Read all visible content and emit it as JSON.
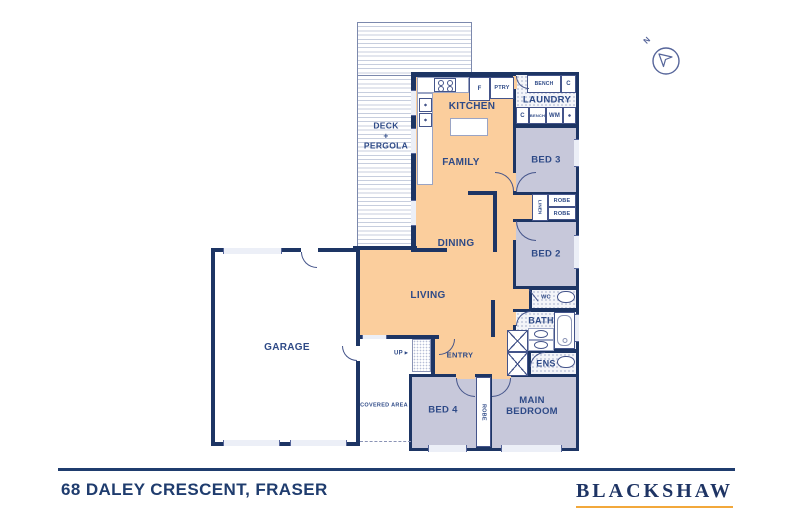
{
  "colors": {
    "wall_navy": "#1d3564",
    "label_blue": "#2e4a87",
    "living_orange": "#fbce9d",
    "bedroom_purple": "#c7c8da",
    "brand_navy": "#1e3464",
    "brand_gold": "#f2a83b"
  },
  "plan": {
    "rooms": {
      "deck": {
        "line1": "DECK",
        "line2": "+",
        "line3": "PERGOLA"
      },
      "kitchen": {
        "label": "KITCHEN"
      },
      "family": {
        "label": "FAMILY"
      },
      "dining": {
        "label": "DINING"
      },
      "living": {
        "label": "LIVING"
      },
      "entry": {
        "label": "ENTRY"
      },
      "garage": {
        "label": "GARAGE"
      },
      "covered_area": {
        "label": "COVERED AREA"
      },
      "laundry": {
        "label": "LAUNDRY"
      },
      "bed3": {
        "label": "BED 3"
      },
      "bed2": {
        "label": "BED 2"
      },
      "bed4": {
        "label": "BED 4"
      },
      "main_bedroom": {
        "label": "MAIN BEDROOM"
      },
      "bath": {
        "label": "BATH"
      },
      "ens": {
        "label": "ENS"
      },
      "wc": {
        "label": "WC"
      }
    },
    "fixtures": {
      "fridge": "F",
      "pantry": "PTRY",
      "bench_top": "BENCH",
      "cupboard_top_right": "C",
      "cupboard_bottom": "C",
      "bench_bottom": "BENCH",
      "washing_machine": "WM",
      "linen": "LINEN",
      "robe_hall_top": "ROBE",
      "robe_hall_bottom": "ROBE",
      "robe_main": "ROBE",
      "stairs_up": "UP ▸"
    },
    "compass": {
      "label": "N"
    }
  },
  "footer": {
    "address": "68 DALEY CRESCENT, FRASER",
    "brand": "BLACKSHAW"
  }
}
